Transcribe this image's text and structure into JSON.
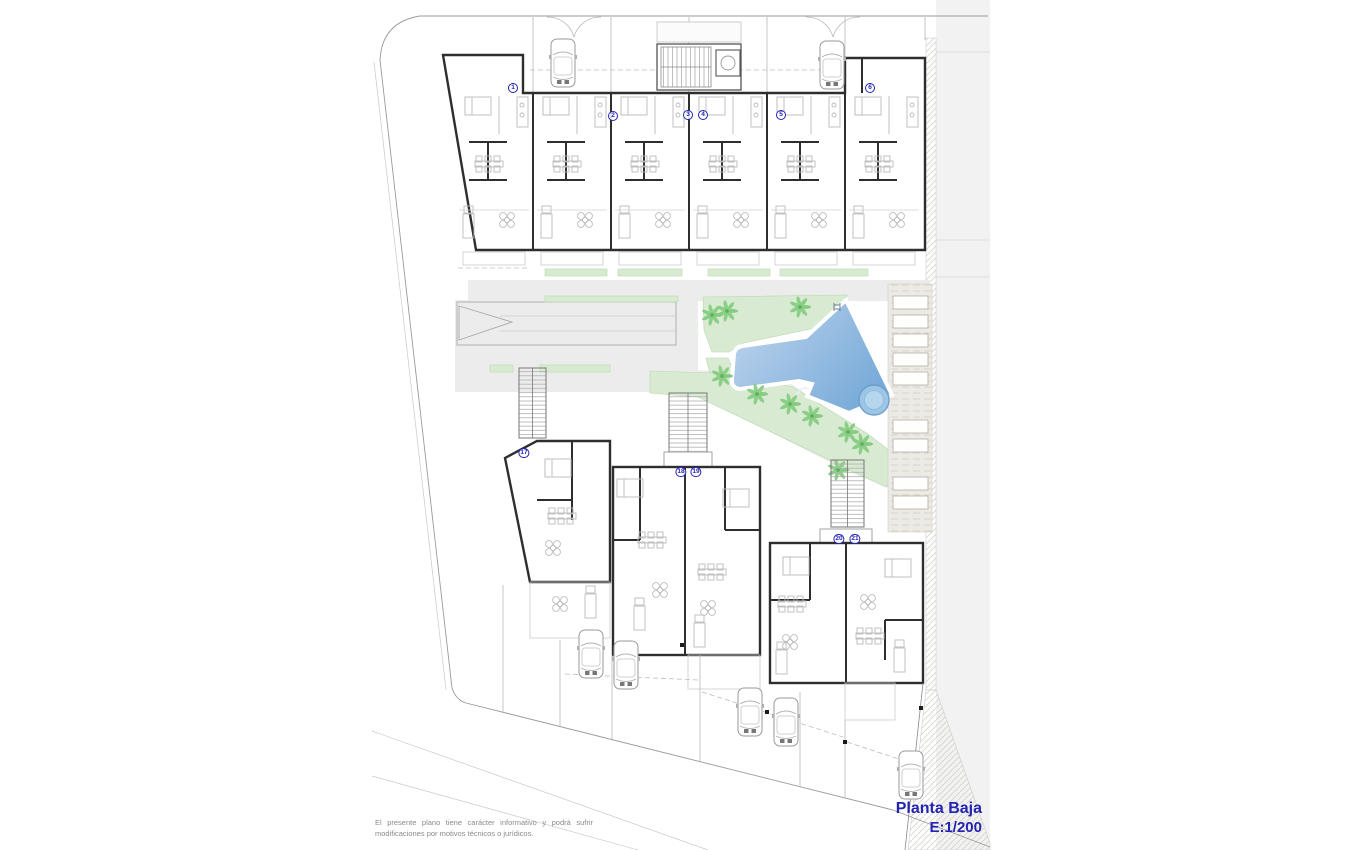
{
  "title": {
    "floor_label": "Planta Baja",
    "scale_label": "E:1/200"
  },
  "disclaimer": {
    "text": "El presente plano tiene carácter informativo y podrá sufrir modificaciones por motivos técnicos o jurídicos."
  },
  "plan": {
    "colors": {
      "accent_text": "#2424b2",
      "wall": "#2e2e2e",
      "furniture": "#bcbcbc",
      "lawn": "#d8ebd2",
      "lawn_line": "#b7d8ae",
      "palm": "#84cc80",
      "pool_light": "#c2d7ee",
      "pool_dark": "#79abd9",
      "spa_fill": "#9cc6e6",
      "spa_ring": "#6d9ecb",
      "paving": "#ececec",
      "street": "#f2f2f2",
      "hatch_bg": "#eceae5"
    },
    "units": [
      {
        "id": "1",
        "x": 513,
        "y": 88
      },
      {
        "id": "2",
        "x": 613,
        "y": 116
      },
      {
        "id": "3",
        "x": 688,
        "y": 115
      },
      {
        "id": "4",
        "x": 703,
        "y": 115
      },
      {
        "id": "5",
        "x": 781,
        "y": 115
      },
      {
        "id": "6",
        "x": 870,
        "y": 88
      },
      {
        "id": "17",
        "x": 524,
        "y": 453
      },
      {
        "id": "18",
        "x": 681,
        "y": 472
      },
      {
        "id": "19",
        "x": 696,
        "y": 472
      },
      {
        "id": "20",
        "x": 839,
        "y": 539
      },
      {
        "id": "21",
        "x": 855,
        "y": 539
      }
    ],
    "top_units_x": [
      455,
      533,
      611,
      689,
      767,
      845
    ],
    "cars": [
      {
        "x": 563,
        "y": 63
      },
      {
        "x": 832,
        "y": 65
      },
      {
        "x": 591,
        "y": 654
      },
      {
        "x": 626,
        "y": 665
      },
      {
        "x": 750,
        "y": 712
      },
      {
        "x": 786,
        "y": 722
      },
      {
        "x": 911,
        "y": 775
      }
    ],
    "palms": [
      {
        "x": 712,
        "y": 315
      },
      {
        "x": 727,
        "y": 311
      },
      {
        "x": 800,
        "y": 307
      },
      {
        "x": 722,
        "y": 376
      },
      {
        "x": 757,
        "y": 394
      },
      {
        "x": 790,
        "y": 404
      },
      {
        "x": 812,
        "y": 416
      },
      {
        "x": 848,
        "y": 432
      },
      {
        "x": 862,
        "y": 444
      },
      {
        "x": 838,
        "y": 470
      }
    ],
    "parking_spaces_y": [
      296,
      315,
      334,
      353,
      372,
      420,
      439,
      477,
      496
    ],
    "posts": [
      {
        "x": 682,
        "y": 645
      },
      {
        "x": 767,
        "y": 712
      },
      {
        "x": 845,
        "y": 742
      },
      {
        "x": 921,
        "y": 708
      },
      {
        "x": 913,
        "y": 780
      }
    ],
    "furniture_clusters": [
      {
        "t": "bed",
        "x": 558,
        "y": 468
      },
      {
        "t": "dining",
        "x": 562,
        "y": 516
      },
      {
        "t": "round",
        "x": 553,
        "y": 548
      },
      {
        "t": "round",
        "x": 560,
        "y": 604
      },
      {
        "t": "sofa",
        "x": 591,
        "y": 606
      },
      {
        "t": "bed",
        "x": 630,
        "y": 488
      },
      {
        "t": "dining",
        "x": 652,
        "y": 540
      },
      {
        "t": "round",
        "x": 660,
        "y": 590
      },
      {
        "t": "sofa",
        "x": 640,
        "y": 618
      },
      {
        "t": "bed",
        "x": 736,
        "y": 498
      },
      {
        "t": "dining",
        "x": 712,
        "y": 572
      },
      {
        "t": "round",
        "x": 708,
        "y": 608
      },
      {
        "t": "sofa",
        "x": 700,
        "y": 635
      },
      {
        "t": "bed",
        "x": 796,
        "y": 566
      },
      {
        "t": "dining",
        "x": 792,
        "y": 604
      },
      {
        "t": "round",
        "x": 790,
        "y": 642
      },
      {
        "t": "sofa",
        "x": 782,
        "y": 662
      },
      {
        "t": "bed",
        "x": 898,
        "y": 568
      },
      {
        "t": "round",
        "x": 868,
        "y": 602
      },
      {
        "t": "dining",
        "x": 870,
        "y": 636
      },
      {
        "t": "sofa",
        "x": 900,
        "y": 660
      },
      {
        "t": "round",
        "x": 320,
        "y": -100
      }
    ]
  }
}
